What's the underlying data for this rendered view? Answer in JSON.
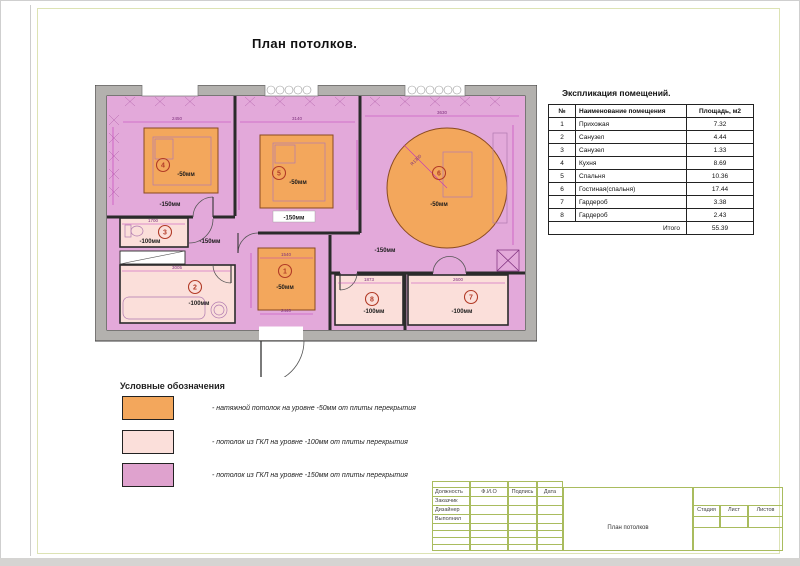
{
  "page": {
    "title": "План потолков."
  },
  "plan": {
    "levels": {
      "l150": "-150мм"
    },
    "rooms": [
      {
        "num": "1",
        "level": "-50мм"
      },
      {
        "num": "2",
        "level": "-100мм"
      },
      {
        "num": "3",
        "level": "-100мм"
      },
      {
        "num": "4",
        "level": "-50мм"
      },
      {
        "num": "5",
        "level": "-50мм"
      },
      {
        "num": "6",
        "level": "-50мм"
      },
      {
        "num": "7",
        "level": "-100мм"
      },
      {
        "num": "8",
        "level": "-100мм"
      }
    ],
    "dims": {
      "d2450": "2450",
      "d3140": "3140",
      "d3630": "3630",
      "d1700": "1700",
      "d3005": "3005",
      "d1540": "1540",
      "d2440": "2440",
      "d1873": "1873",
      "d2600": "2600",
      "r1300": "R1300"
    }
  },
  "explication": {
    "title": "Экспликация помещений.",
    "columns": [
      "№",
      "Наименование помещения",
      "Площадь, м2"
    ],
    "rows": [
      [
        "1",
        "Прихожая",
        "7.32"
      ],
      [
        "2",
        "Санузел",
        "4.44"
      ],
      [
        "3",
        "Санузел",
        "1.33"
      ],
      [
        "4",
        "Кухня",
        "8.69"
      ],
      [
        "5",
        "Спальня",
        "10.36"
      ],
      [
        "6",
        "Гостиная(спальня)",
        "17.44"
      ],
      [
        "7",
        "Гардероб",
        "3.38"
      ],
      [
        "8",
        "Гардероб",
        "2.43"
      ]
    ],
    "total_label": "Итого",
    "total_value": "55.39"
  },
  "legend": {
    "title": "Условные обозначения",
    "items": [
      {
        "color": "#f3a75c",
        "label": "- натяжной потолок на уровне  -50мм от плиты перекрытия"
      },
      {
        "color": "#fbdfda",
        "label": "- потолок из ГКЛ на уровне  -100мм от плиты перекрытия"
      },
      {
        "color": "#dfa2ce",
        "label": "- потолок из ГКЛ на уровне  -150мм от плиты перекрытия"
      }
    ]
  },
  "title_block": {
    "col_headers": [
      "Должность",
      "Ф.И.О",
      "Подпись",
      "Дата"
    ],
    "rows": [
      "Заказчик",
      "Дизайнер",
      "Выполнил"
    ],
    "stage_headers": [
      "Стадия",
      "Лист",
      "Листов"
    ],
    "drawing_title": "План потолков"
  },
  "colors": {
    "stretch_ceiling": "#f3a75c",
    "gkl_100": "#fbdfda",
    "gkl_150": "#dfa2ce",
    "walls": "#b3b1ae",
    "dimension_lines": "#c23ab8",
    "stamp_lines": "#a9bc5e"
  }
}
